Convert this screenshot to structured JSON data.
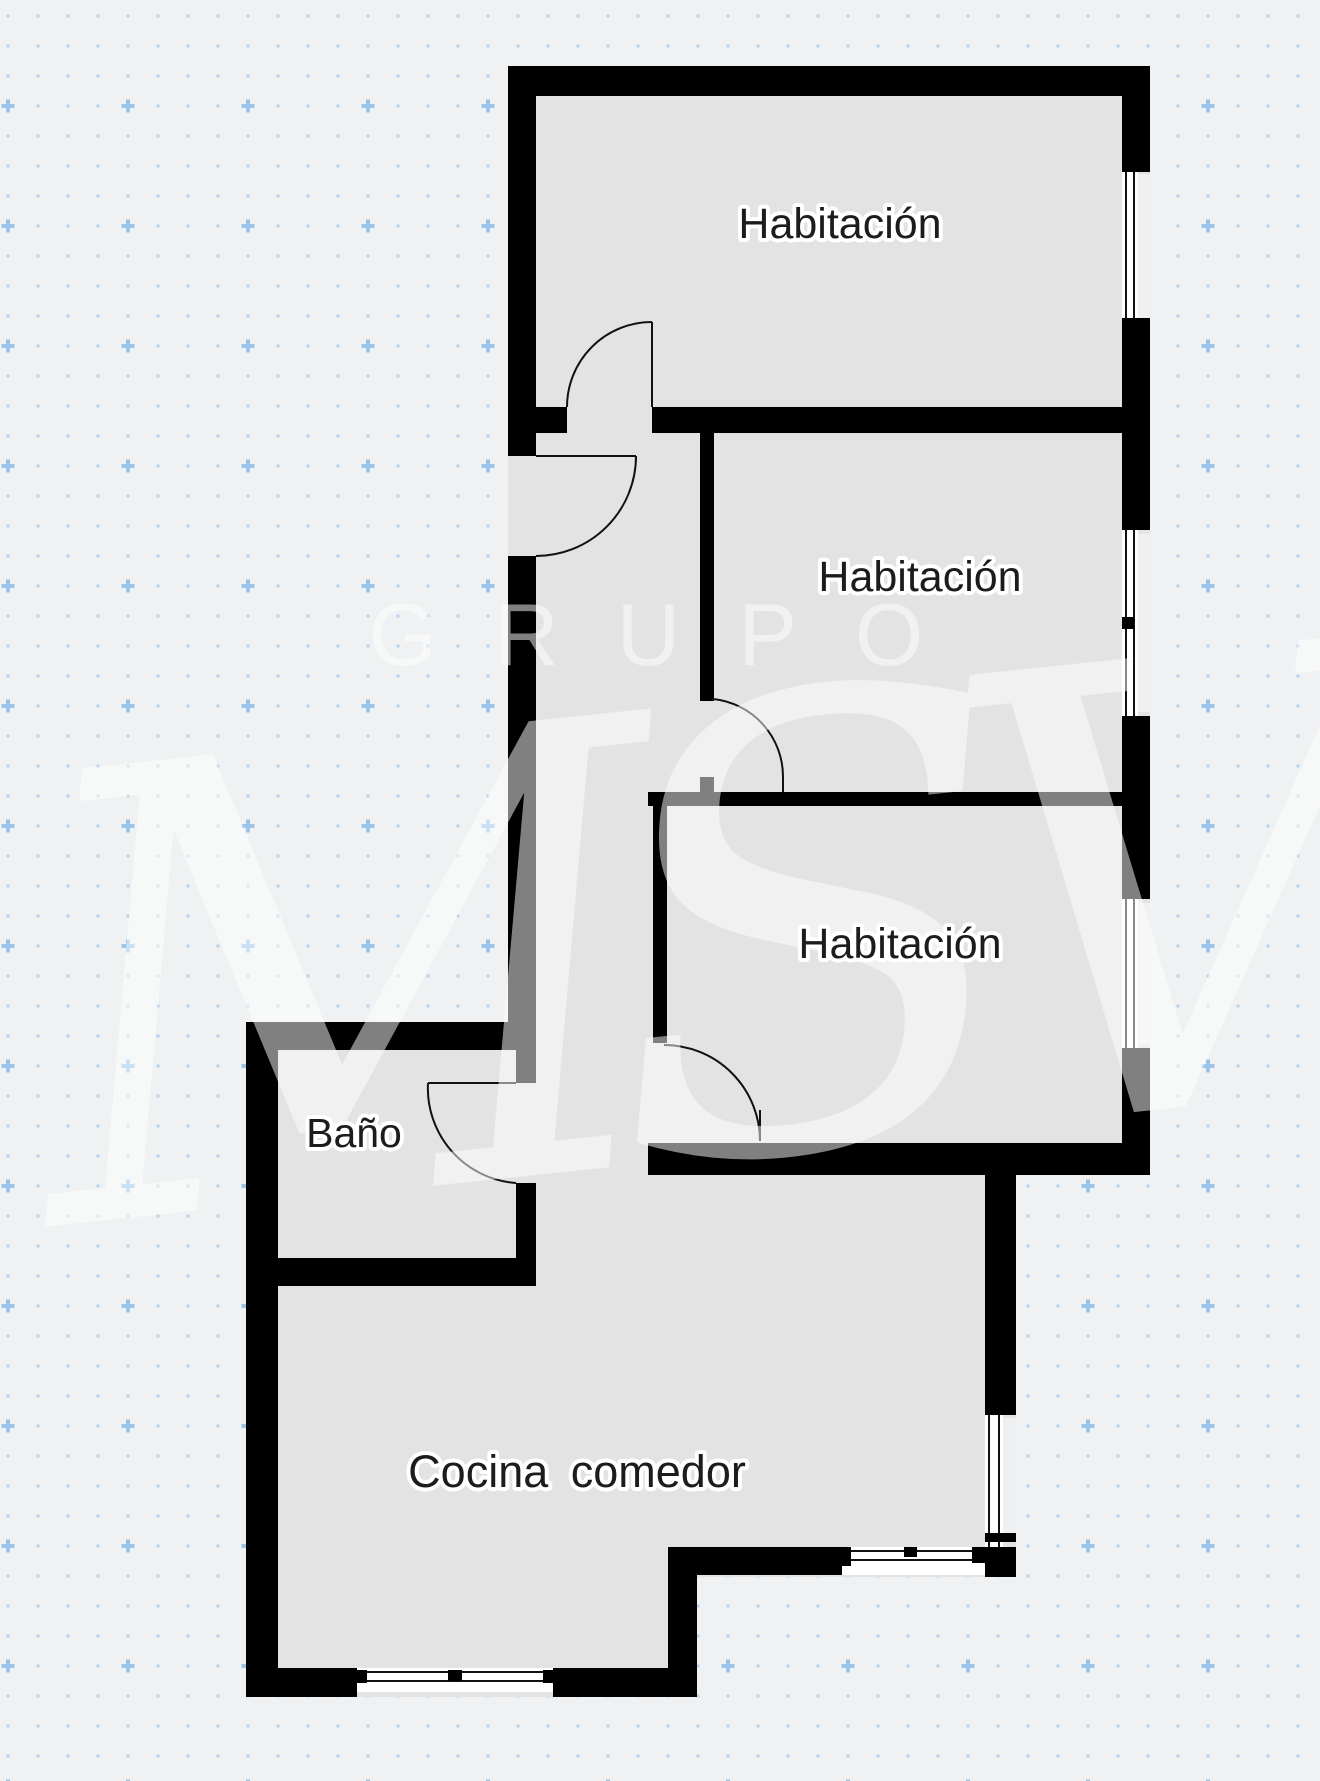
{
  "plan": {
    "rooms": [
      {
        "id": "habitacion-1",
        "label": "Habitación"
      },
      {
        "id": "habitacion-2",
        "label": "Habitación"
      },
      {
        "id": "habitacion-3",
        "label": "Habitación"
      },
      {
        "id": "bano",
        "label": "Baño"
      },
      {
        "id": "cocina-comedor",
        "label": "Cocina comedor"
      }
    ]
  },
  "watermark": {
    "brand": "GRUPO",
    "monogram": "MSV"
  },
  "colors": {
    "background": "#f0f1f2",
    "grid_dot": "#b5d2ee",
    "grid_cross": "#9cc3e9",
    "floor": "#e3e3e4",
    "wall": "#000000",
    "window_fill": "#ffffff",
    "window_line": "#111111",
    "door_line": "#111111",
    "label_text": "#1c1c1c",
    "label_halo": "#ffffff",
    "watermark": "#ffffff"
  }
}
